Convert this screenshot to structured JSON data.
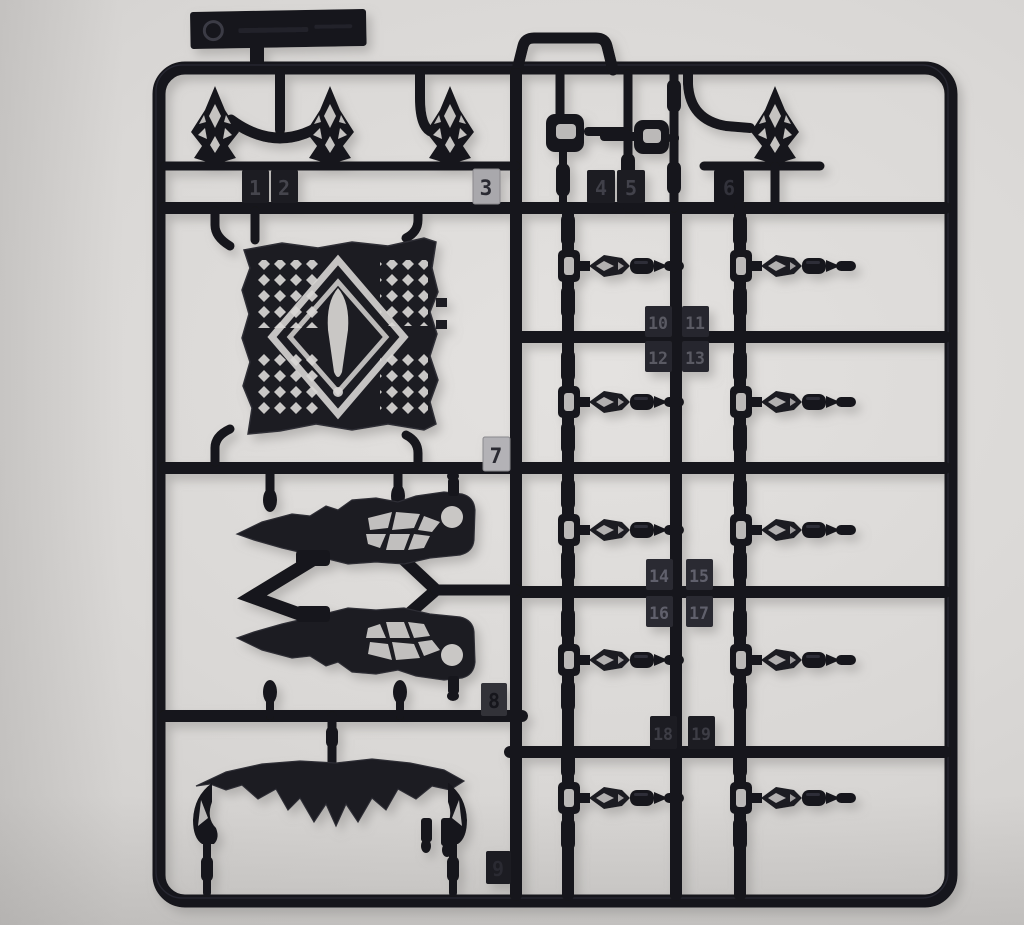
{
  "photo": {
    "palette": {
      "background": "#d8d6d4",
      "plastic_dark": "#15151a",
      "plastic_mid": "#1b1b21",
      "plastic_highlight": "#34343d",
      "tag_silver": "#b0afb3",
      "shadow": "#8e8c8a"
    }
  },
  "labels": {
    "part_numbers": [
      "1",
      "2",
      "3",
      "4",
      "5",
      "6",
      "7",
      "8",
      "9",
      "10",
      "11",
      "12",
      "13",
      "14",
      "15",
      "16",
      "17",
      "18",
      "19"
    ]
  }
}
